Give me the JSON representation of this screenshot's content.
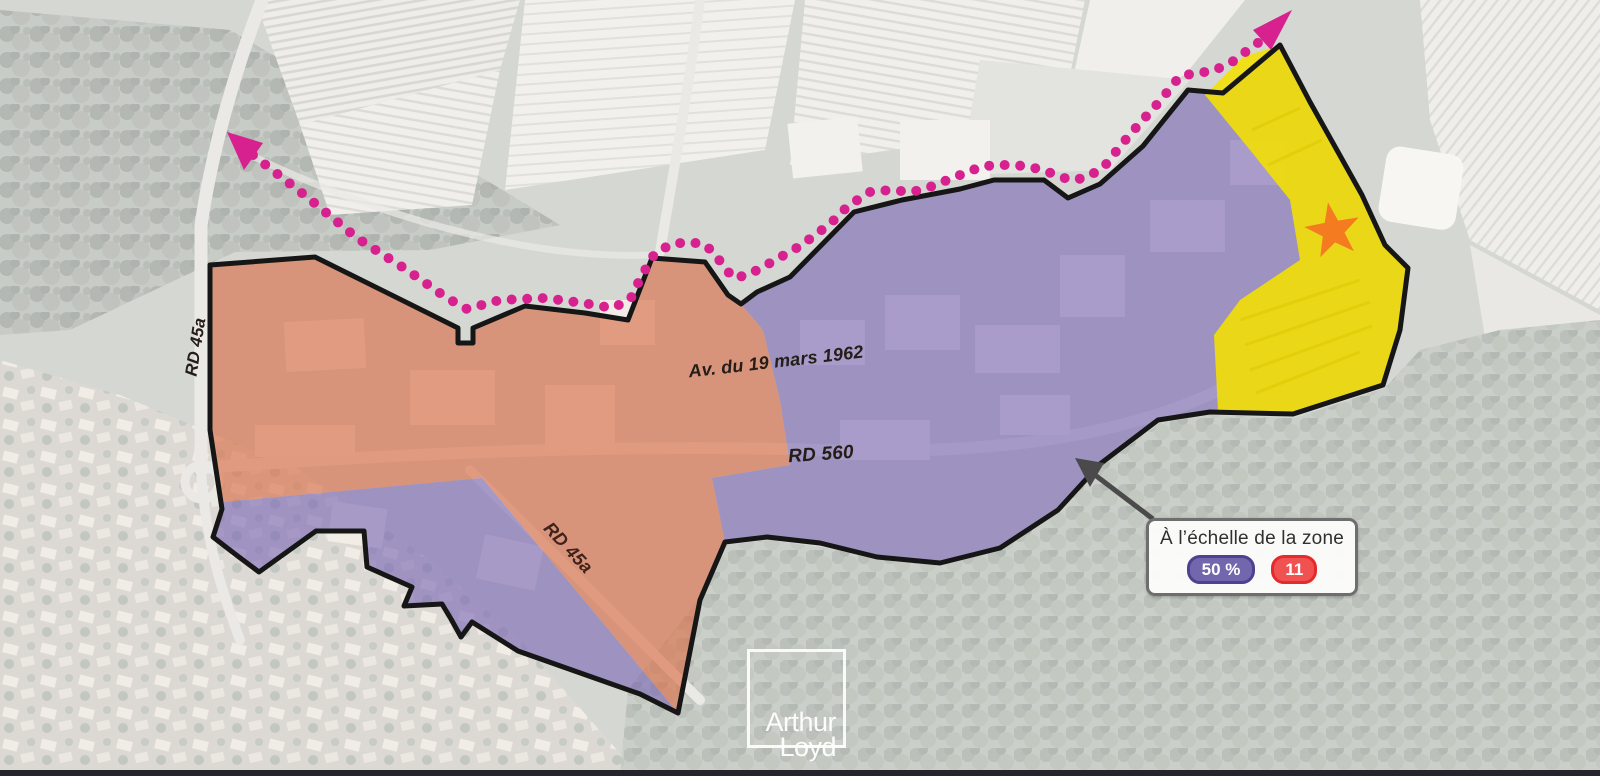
{
  "map": {
    "type": "aerial-zoning-map",
    "roads": {
      "rd45a_west": "RD 45a",
      "avenue": "Av. du 19 mars 1962",
      "rd560": "RD 560",
      "rd45a_south": "RD 45a"
    },
    "zones": [
      {
        "name": "orange-zone",
        "color": "#d9744f"
      },
      {
        "name": "purple-zone",
        "color": "#7a68b5"
      },
      {
        "name": "yellow-zone",
        "color": "#f4e000"
      }
    ],
    "route": {
      "style": "dotted",
      "arrows": [
        "northwest",
        "northeast"
      ]
    },
    "star_marker": {
      "zone": "yellow-zone"
    }
  },
  "colors": {
    "orange_zone": "#d9744f",
    "purple_zone": "#7a68b5",
    "yellow_zone": "#f4e000",
    "route": "#d7218e",
    "outline": "#161616",
    "star": "#f47b20",
    "legend_purple": "#7266ad",
    "legend_red": "#f05151"
  },
  "legend": {
    "title": "À l’échelle de la zone",
    "purple_badge": "50 %",
    "red_badge": "11"
  },
  "watermark": {
    "line1": "Arthur",
    "line2": "Loyd"
  }
}
